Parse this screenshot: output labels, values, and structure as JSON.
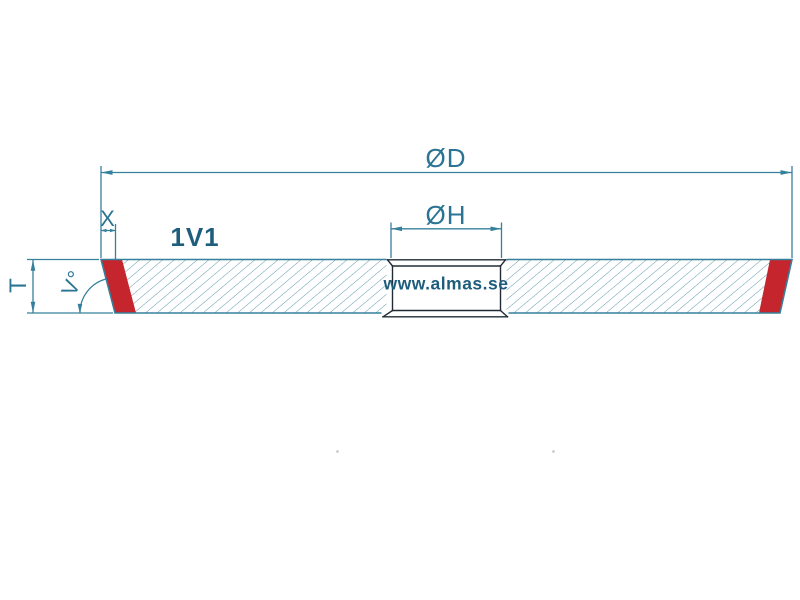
{
  "drawing": {
    "type_label": "1V1",
    "watermark": "www.almas.se",
    "labels": {
      "outer_diameter": "ØD",
      "hole_diameter": "ØH",
      "rim_width": "X",
      "thickness": "T",
      "bevel_angle": "V°"
    }
  },
  "colors": {
    "line": "#35809c",
    "label_text": "#2b7493",
    "dark_text": "#1f5d7d",
    "red": "#c5252c",
    "hatch": "#44889e",
    "hole_outline": "#212b36",
    "background": "#ffffff"
  }
}
